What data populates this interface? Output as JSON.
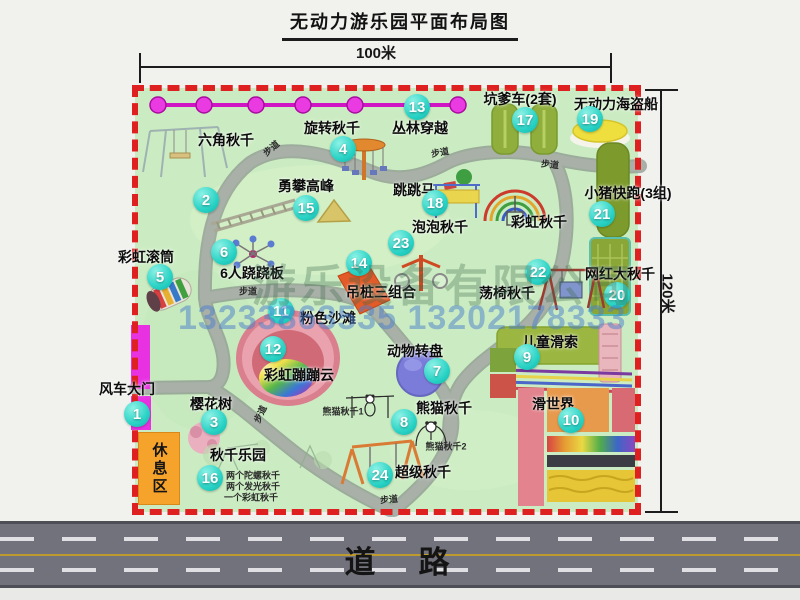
{
  "title": "无动力游乐园平面布局图",
  "dimensions": {
    "width": "100米",
    "height": "120米"
  },
  "road": {
    "label": "道　路"
  },
  "watermark": {
    "company": "游乐设备有限公司",
    "phones": "13233863535 13202178333"
  },
  "rest_area": {
    "label": "休息区"
  },
  "colors": {
    "map_green": "#cbecc2",
    "border_red": "#df2020",
    "badge_cyan": "#27d2c4",
    "zipline_magenta": "#e63ae2",
    "road_gray": "#72727c",
    "rest_orange": "#f6a32b"
  },
  "attractions": [
    {
      "num": "1",
      "name": "风车大门",
      "lx": 127,
      "ly": 389,
      "bx": 137,
      "by": 414
    },
    {
      "num": "2",
      "name": "六角秋千",
      "lx": 226,
      "ly": 140,
      "bx": 206,
      "by": 200
    },
    {
      "num": "3",
      "name": "樱花树",
      "lx": 211,
      "ly": 404,
      "bx": 214,
      "by": 422
    },
    {
      "num": "4",
      "name": "旋转秋千",
      "lx": 332,
      "ly": 128,
      "bx": 343,
      "by": 149
    },
    {
      "num": "5",
      "name": "彩虹滚筒",
      "lx": 146,
      "ly": 257,
      "bx": 160,
      "by": 277
    },
    {
      "num": "6",
      "name": "6人跷跷板",
      "lx": 252,
      "ly": 273,
      "bx": 224,
      "by": 252
    },
    {
      "num": "7",
      "name": "动物转盘",
      "lx": 415,
      "ly": 351,
      "bx": 437,
      "by": 371
    },
    {
      "num": "8",
      "name": "熊猫秋千",
      "lx": 444,
      "ly": 408,
      "bx": 404,
      "by": 422
    },
    {
      "num": "9",
      "name": "儿童滑索",
      "lx": 550,
      "ly": 342,
      "bx": 527,
      "by": 357
    },
    {
      "num": "10",
      "name": "滑世界",
      "lx": 553,
      "ly": 404,
      "bx": 571,
      "by": 420
    },
    {
      "num": "11",
      "name": "粉色沙滩",
      "lx": 328,
      "ly": 318,
      "bx": 281,
      "by": 311
    },
    {
      "num": "12",
      "name": "彩虹蹦蹦云",
      "lx": 299,
      "ly": 375,
      "bx": 273,
      "by": 349
    },
    {
      "num": "13",
      "name": "丛林穿越",
      "lx": 420,
      "ly": 128,
      "bx": 417,
      "by": 107
    },
    {
      "num": "14",
      "name": "吊桩三组合",
      "lx": 381,
      "ly": 292,
      "bx": 359,
      "by": 263
    },
    {
      "num": "15",
      "name": "勇攀高峰",
      "lx": 306,
      "ly": 186,
      "bx": 306,
      "by": 208
    },
    {
      "num": "16",
      "name": "秋千乐园",
      "lx": 238,
      "ly": 455,
      "bx": 210,
      "by": 478
    },
    {
      "num": "17",
      "name": "坑爹车(2套)",
      "lx": 520,
      "ly": 99,
      "bx": 525,
      "by": 120
    },
    {
      "num": "18",
      "name": "跳跳马",
      "lx": 414,
      "ly": 190,
      "bx": 435,
      "by": 203
    },
    {
      "num": "19",
      "name": "无动力海盗船",
      "lx": 616,
      "ly": 104,
      "bx": 590,
      "by": 119
    },
    {
      "num": "20",
      "name": "网红大秋千",
      "lx": 620,
      "ly": 274,
      "bx": 617,
      "by": 295
    },
    {
      "num": "21",
      "name": "小猪快跑(3组)",
      "lx": 628,
      "ly": 193,
      "bx": 602,
      "by": 214
    },
    {
      "num": "22",
      "name": "荡椅秋千",
      "lx": 507,
      "ly": 293,
      "bx": 538,
      "by": 272
    },
    {
      "num": "23",
      "name": "泡泡秋千",
      "lx": 440,
      "ly": 227,
      "bx": 401,
      "by": 243
    },
    {
      "num": "24",
      "name": "超级秋千",
      "lx": 423,
      "ly": 472,
      "bx": 380,
      "by": 475
    },
    {
      "num": null,
      "name": "彩虹秋千",
      "lx": 539,
      "ly": 222,
      "bx": 0,
      "by": 0
    }
  ],
  "notes": [
    {
      "text": "熊猫秋千1",
      "x": 343,
      "y": 411
    },
    {
      "text": "熊猫秋千2",
      "x": 446,
      "y": 446
    },
    {
      "text": "两个陀螺秋千",
      "x": 253,
      "y": 475
    },
    {
      "text": "两个发光秋千",
      "x": 253,
      "y": 486
    },
    {
      "text": "一个彩虹秋千",
      "x": 251,
      "y": 497
    }
  ],
  "path_labels": [
    {
      "text": "步道",
      "x": 271,
      "y": 148,
      "rot": -40
    },
    {
      "text": "步道",
      "x": 440,
      "y": 152,
      "rot": -10
    },
    {
      "text": "步道",
      "x": 550,
      "y": 164,
      "rot": 6
    },
    {
      "text": "步道",
      "x": 248,
      "y": 291,
      "rot": 0
    },
    {
      "text": "步道",
      "x": 260,
      "y": 414,
      "rot": -65
    },
    {
      "text": "步道",
      "x": 389,
      "y": 499,
      "rot": -5
    }
  ]
}
